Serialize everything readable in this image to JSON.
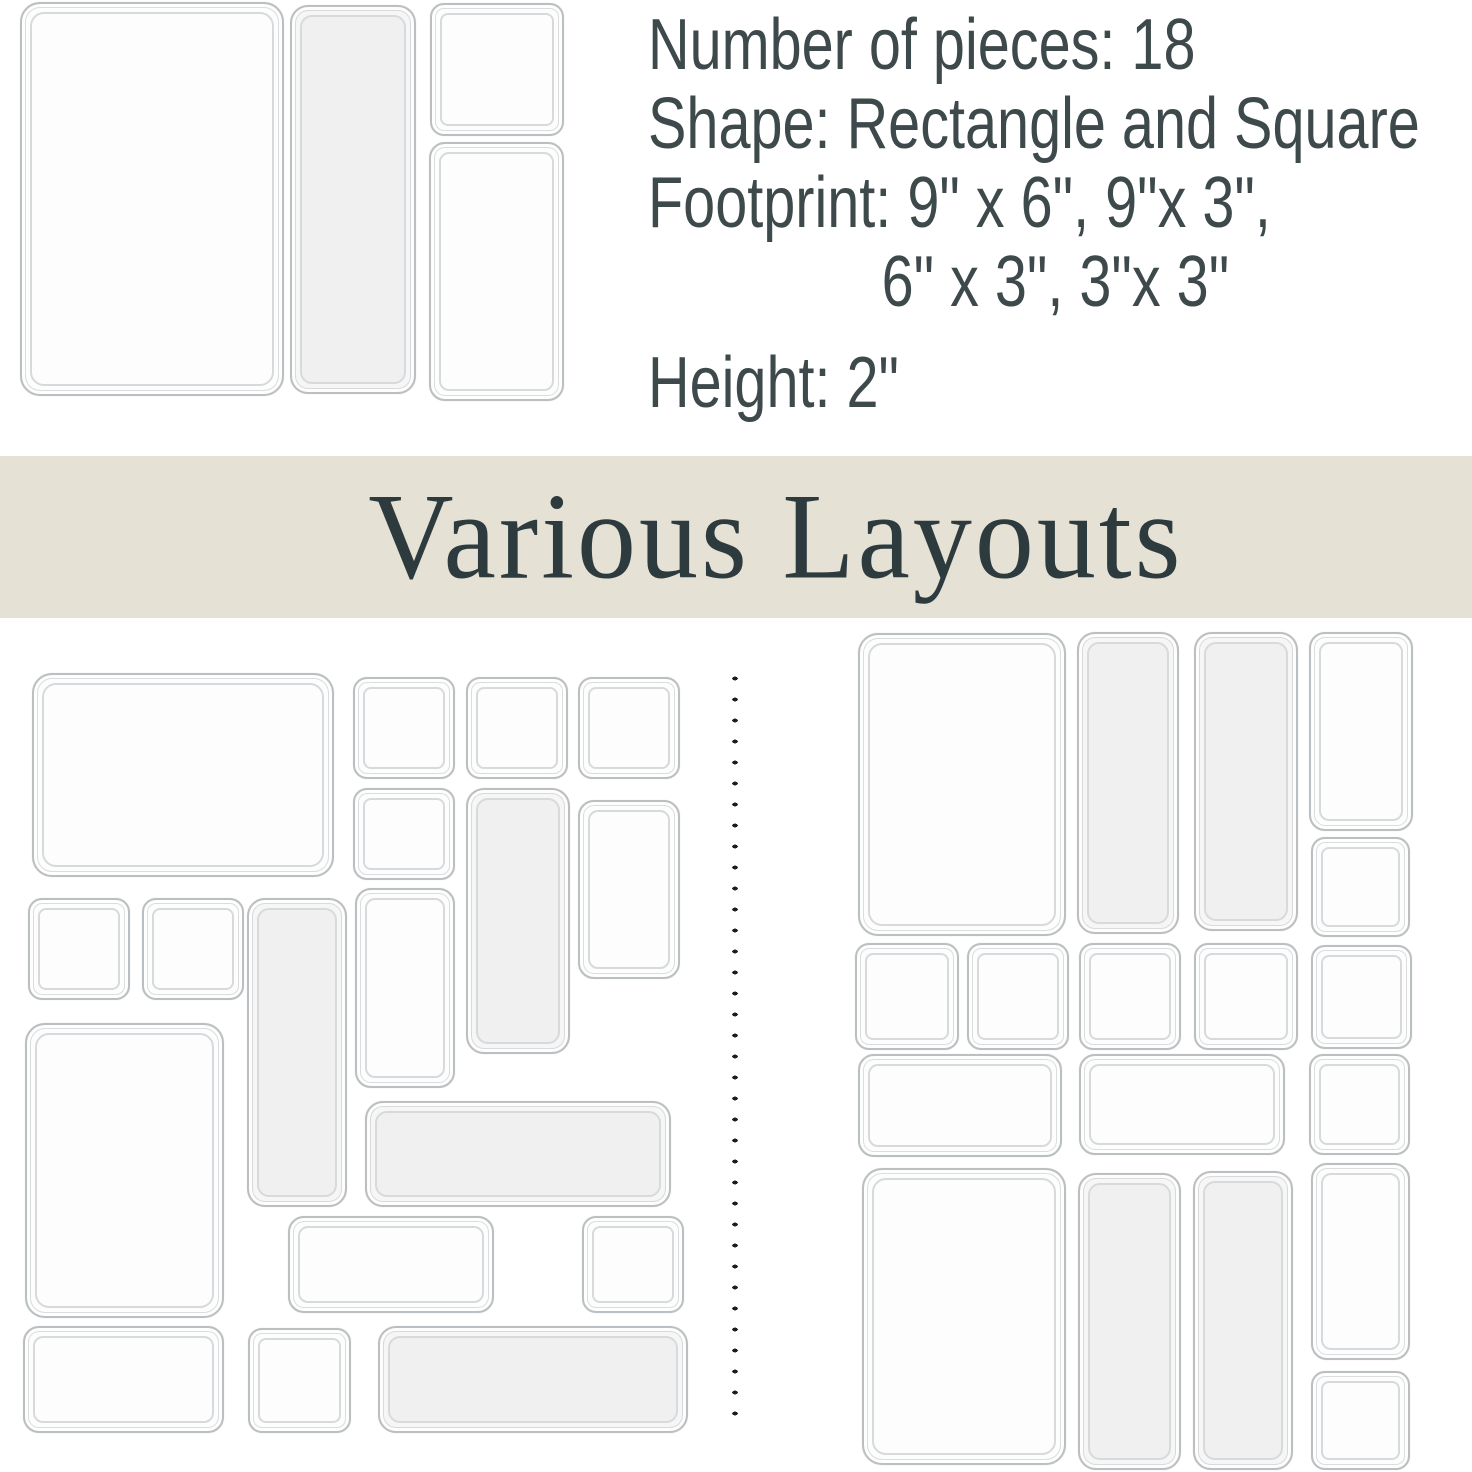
{
  "specs": {
    "pieces": "Number of pieces: 18",
    "shape": "Shape: Rectangle and Square",
    "footprint_line1": "Footprint: 9\" x 6\", 9\"x 3\",",
    "footprint_line2": "6\" x 3\", 3\"x 3\"",
    "height": "Height: 2\""
  },
  "banner": {
    "title": "Various Layouts",
    "background_color": "#e5e1d5",
    "text_color": "#2e3b3e"
  },
  "colors": {
    "page_background": "#ffffff",
    "spec_text": "#3d494b",
    "tray_border": "#bcbfc1",
    "tray_inner_border": "#d7dadb",
    "tray_fill": "#fdfdfd",
    "divider_dot": "#1c1c1c"
  },
  "hero_trays": [
    {
      "x": 20,
      "y": 2,
      "w": 260,
      "h": 390,
      "size": "9x6"
    },
    {
      "x": 290,
      "y": 5,
      "w": 122,
      "h": 385,
      "size": "9x3",
      "tint": true
    },
    {
      "x": 430,
      "y": 3,
      "w": 130,
      "h": 129,
      "size": "3x3"
    },
    {
      "x": 429,
      "y": 142,
      "w": 131,
      "h": 255,
      "size": "6x3"
    }
  ],
  "layout_left_trays": [
    {
      "x": 32,
      "y": 673,
      "w": 298,
      "h": 200,
      "size": "9x6"
    },
    {
      "x": 353,
      "y": 677,
      "w": 98,
      "h": 98,
      "size": "3x3"
    },
    {
      "x": 466,
      "y": 677,
      "w": 98,
      "h": 98,
      "size": "3x3"
    },
    {
      "x": 578,
      "y": 677,
      "w": 98,
      "h": 98,
      "size": "3x3"
    },
    {
      "x": 353,
      "y": 788,
      "w": 98,
      "h": 88,
      "size": "3x3"
    },
    {
      "x": 466,
      "y": 788,
      "w": 100,
      "h": 262,
      "size": "9x3",
      "tint": true
    },
    {
      "x": 578,
      "y": 800,
      "w": 98,
      "h": 175,
      "size": "6x3"
    },
    {
      "x": 28,
      "y": 898,
      "w": 98,
      "h": 98,
      "size": "3x3"
    },
    {
      "x": 142,
      "y": 898,
      "w": 98,
      "h": 98,
      "size": "3x3"
    },
    {
      "x": 247,
      "y": 898,
      "w": 96,
      "h": 305,
      "size": "9x3",
      "tint": true
    },
    {
      "x": 355,
      "y": 888,
      "w": 96,
      "h": 196,
      "size": "6x3"
    },
    {
      "x": 25,
      "y": 1023,
      "w": 195,
      "h": 291,
      "size": "9x6"
    },
    {
      "x": 365,
      "y": 1101,
      "w": 302,
      "h": 102,
      "size": "9x3",
      "tint": true
    },
    {
      "x": 288,
      "y": 1216,
      "w": 202,
      "h": 93,
      "size": "6x3"
    },
    {
      "x": 582,
      "y": 1216,
      "w": 98,
      "h": 93,
      "size": "3x3"
    },
    {
      "x": 23,
      "y": 1326,
      "w": 197,
      "h": 103,
      "size": "6x3"
    },
    {
      "x": 248,
      "y": 1328,
      "w": 99,
      "h": 101,
      "size": "3x3"
    },
    {
      "x": 378,
      "y": 1326,
      "w": 306,
      "h": 103,
      "size": "9x3",
      "tint": true
    }
  ],
  "layout_right_trays": [
    {
      "x": 858,
      "y": 633,
      "w": 204,
      "h": 299,
      "size": "9x6"
    },
    {
      "x": 1077,
      "y": 632,
      "w": 98,
      "h": 298,
      "size": "9x3",
      "tint": true
    },
    {
      "x": 1194,
      "y": 632,
      "w": 100,
      "h": 295,
      "size": "9x3",
      "tint": true
    },
    {
      "x": 1309,
      "y": 632,
      "w": 100,
      "h": 195,
      "size": "6x3"
    },
    {
      "x": 1311,
      "y": 837,
      "w": 95,
      "h": 96,
      "size": "3x3"
    },
    {
      "x": 855,
      "y": 943,
      "w": 100,
      "h": 103,
      "size": "3x3"
    },
    {
      "x": 967,
      "y": 943,
      "w": 98,
      "h": 103,
      "size": "3x3"
    },
    {
      "x": 1079,
      "y": 943,
      "w": 98,
      "h": 103,
      "size": "3x3"
    },
    {
      "x": 1194,
      "y": 943,
      "w": 100,
      "h": 103,
      "size": "3x3"
    },
    {
      "x": 1311,
      "y": 945,
      "w": 97,
      "h": 100,
      "size": "3x3"
    },
    {
      "x": 858,
      "y": 1054,
      "w": 200,
      "h": 99,
      "size": "6x3"
    },
    {
      "x": 1079,
      "y": 1054,
      "w": 202,
      "h": 97,
      "size": "6x3"
    },
    {
      "x": 1309,
      "y": 1054,
      "w": 97,
      "h": 97,
      "size": "3x3"
    },
    {
      "x": 862,
      "y": 1168,
      "w": 200,
      "h": 293,
      "size": "9x6"
    },
    {
      "x": 1078,
      "y": 1173,
      "w": 99,
      "h": 293,
      "size": "9x3",
      "tint": true
    },
    {
      "x": 1193,
      "y": 1171,
      "w": 96,
      "h": 295,
      "size": "9x3",
      "tint": true
    },
    {
      "x": 1311,
      "y": 1163,
      "w": 95,
      "h": 193,
      "size": "6x3"
    },
    {
      "x": 1311,
      "y": 1371,
      "w": 95,
      "h": 95,
      "size": "3x3"
    }
  ],
  "divider": {
    "x": 731,
    "top": 668,
    "height": 762
  }
}
